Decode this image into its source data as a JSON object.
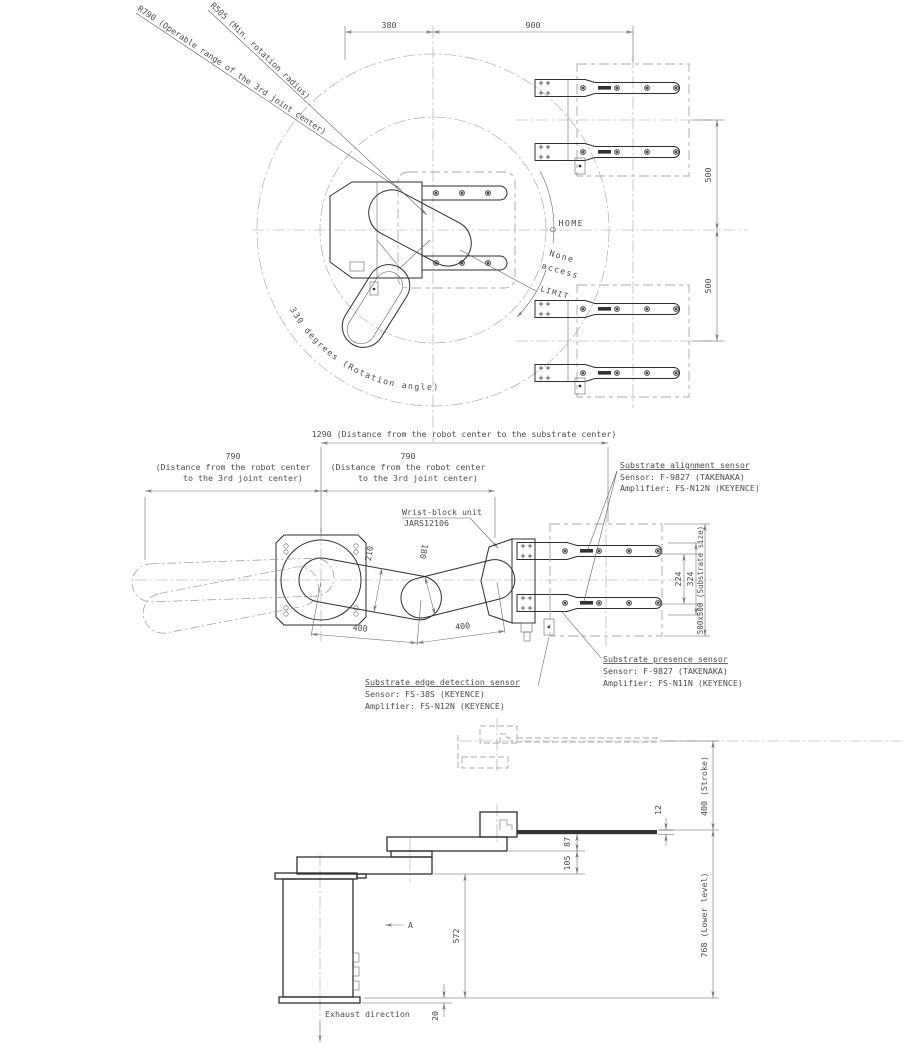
{
  "drawing_colors": {
    "outline": "#2e2e2e",
    "dimension": "#787878",
    "centerline": "#a3a3a3",
    "background": "#ffffff"
  },
  "top": {
    "r790": "R790 (Operable range of the 3rd joint center)",
    "r505": "R505 (Min. rotation radius)",
    "d380": "380",
    "d900": "900",
    "d500a": "500",
    "d500b": "500",
    "home": "HOME",
    "none1": "None",
    "none2": "access",
    "limit": "LIMIT",
    "rot": "330 degrees (Rotation angle)"
  },
  "middle": {
    "d1290": "1290 (Distance from the robot center to the substrate center)",
    "d790": "790",
    "d790l1": "(Distance from the robot center",
    "d790l2": "to the 3rd joint center)",
    "wrist1": "Wrist-block unit",
    "wrist2": "JARS12106",
    "d210": "210",
    "d180": "180",
    "d400a": "400",
    "d400b": "400",
    "d224": "224",
    "d324": "324",
    "dsub": "500x500 (Substrate size)",
    "align_t": "Substrate alignment sensor",
    "align_s": "Sensor: F-9827 (TAKENAKA)",
    "align_a": "Amplifier: FS-N12N (KEYENCE)",
    "pres_t": "Substrate presence sensor",
    "pres_s": "Sensor: F-9827 (TAKENAKA)",
    "pres_a": "Amplifier: FS-N11N (KEYENCE)",
    "edge_t": "Substrate edge detection sensor",
    "edge_s": "Sensor: FS-38S (KEYENCE)",
    "edge_a": "Amplifier: FS-N12N (KEYENCE)"
  },
  "bottom": {
    "stroke": "400 (Stroke)",
    "lower": "768 (Lower level)",
    "d12": "12",
    "d87": "87",
    "d105": "105",
    "d572": "572",
    "d20": "20",
    "a": "A",
    "exhaust": "Exhaust direction"
  }
}
